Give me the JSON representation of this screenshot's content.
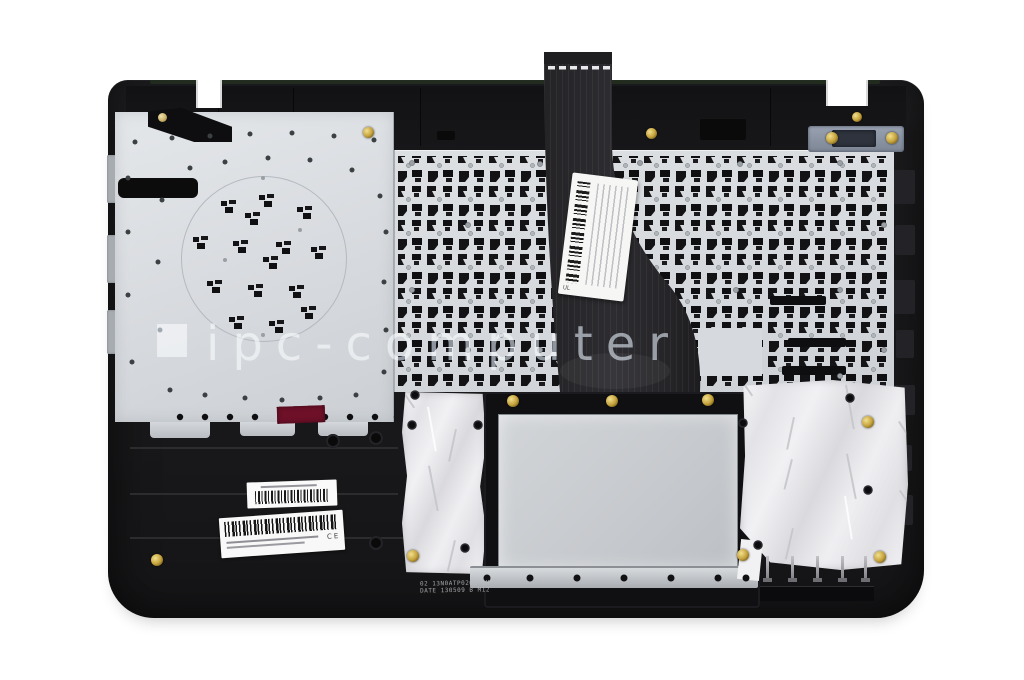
{
  "photo": {
    "description": "Rear view photograph of a black laptop top case (palmrest) with mounted keyboard plate, ribbon cable, touchpad cut-out, foil shielding and service barcode labels",
    "background": "#ffffff"
  },
  "watermark": {
    "logo": "square-mark",
    "text": "ipc-computer"
  },
  "stamp": {
    "line1": "02 13N0ATP0201 1M",
    "line2": "DATE 130509 B M12"
  },
  "labels": {
    "cable_label_icon": "vertical-barcode",
    "cable_label_ul": "UL",
    "small_label_icon": "barcode",
    "large_label_icon": "barcode",
    "large_label_marks": "CE"
  },
  "colors": {
    "case": "#1b1b1d",
    "keyboard_plate": "#d7dade",
    "touchpad_plate": "#c9ccd0",
    "foil": "#ebebed",
    "ribbon_cable": "#29282b",
    "brass_screw": "#c5a23c",
    "watermark": "#8d959d",
    "red_sticker": "#6d1028"
  }
}
